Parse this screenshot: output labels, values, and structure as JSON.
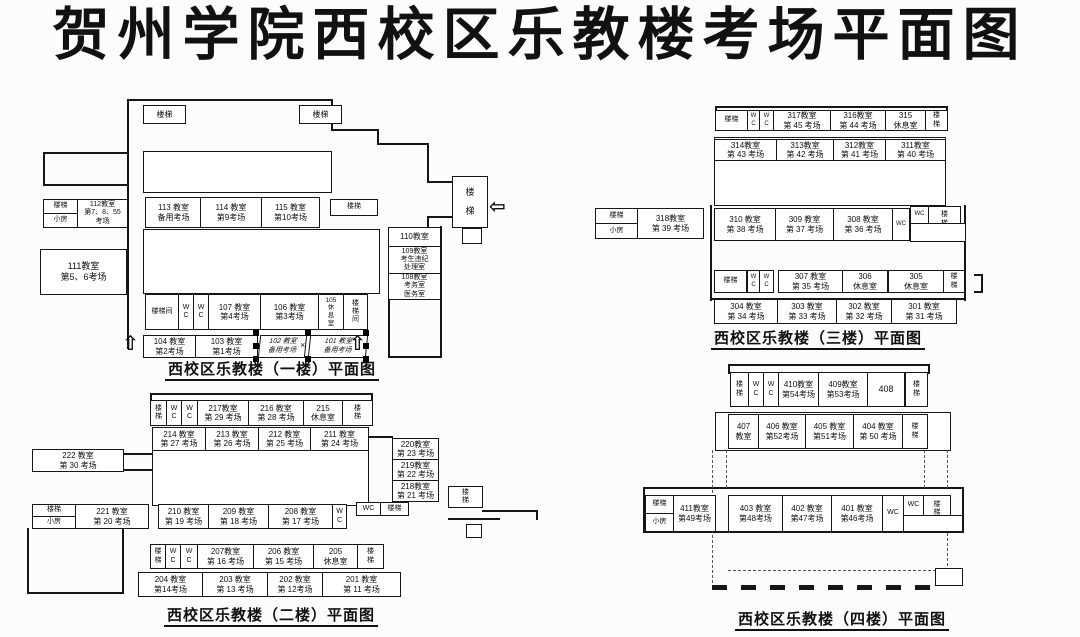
{
  "title": "贺州学院西校区乐教楼考场平面图",
  "labels": {
    "stair": "楼梯",
    "stair_v": "楼\n梯",
    "stairwell": "楼梯间",
    "stairwell_v": "楼\n梯\n间",
    "small_room": "小房",
    "wc_v": "W\nC",
    "wc": "WC",
    "arrow_up": "⇧",
    "arrow_in": "⇦",
    "x_mark": "×"
  },
  "floor1": {
    "caption": "西校区乐教楼（一楼）平面图",
    "r112": "112教室\n第7、8、55\n考场",
    "r111": "111教室\n第5、6考场",
    "r113": "113 教室\n备用考场",
    "r114": "114 教室\n第9考场",
    "r115": "115 教室\n第10考场",
    "r110": "110教室",
    "r109": "109教室\n考生违纪\n处理室",
    "r108": "108教室\n考务室\n医务室",
    "r107": "107 教室\n第4考场",
    "r106": "106 教室\n第3考场",
    "r105": "105\n休\n息\n室",
    "r104": "104 教室\n第2考场",
    "r103": "103 教室\n第1考场",
    "r102": "102 教室\n备用考场",
    "r101": "101 教室\n备用考场"
  },
  "floor2": {
    "caption": "西校区乐教楼（二楼）平面图",
    "r217": "217教室\n第 29 考场",
    "r216": "216 教室\n第 28 考场",
    "r215": "215\n休息室",
    "r214": "214 教室\n第 27 考场",
    "r213": "213 教室\n第 26 考场",
    "r212": "212 教室\n第 25 考场",
    "r211": "211 教室\n第 24 考场",
    "r222": "222 教室\n第 30 考场",
    "r220": "220教室\n第 23 考场",
    "r219": "219教室\n第 22 考场",
    "r218": "218教室\n第 21 考场",
    "r221": "221 教室\n第 20 考场",
    "r210": "210 教室\n第 19 考场",
    "r209": "209 教室\n第 18 考场",
    "r208": "208 教室\n第 17 考场",
    "r207": "207教室\n第 16 考场",
    "r206": "206 教室\n第 15 考场",
    "r205": "205\n休息室",
    "r204": "204 教室\n第14考场",
    "r203": "203 教室\n第 13 考场",
    "r202": "202 教室\n第 12考场",
    "r201": "201 教室\n第 11 考场"
  },
  "floor3": {
    "caption": "西校区乐教楼（三楼）平面图",
    "r317": "317教室\n第 45 考场",
    "r316": "316教室\n第 44 考场",
    "r315": "315\n休息室",
    "r314": "314教室\n第 43 考场",
    "r313": "313教室\n第 42 考场",
    "r312": "312教室\n第 41 考场",
    "r311": "311教室\n第 40 考场",
    "r318": "318教室\n第 39 考场",
    "r310": "310 教室\n第 38 考场",
    "r309": "309 教室\n第 37 考场",
    "r308": "308 教室\n第 36 考场",
    "r307": "307 教室\n第 35 考场",
    "r306": "306\n休息室",
    "r305": "305\n休息室",
    "r304": "304 教室\n第 34 考场",
    "r303": "303 教室\n第 33 考场",
    "r302": "302 教室\n第 32 考场",
    "r301": "301 教室\n第 31 考场"
  },
  "floor4": {
    "caption": "西校区乐教楼（四楼）平面图",
    "r410": "410教室\n第54考场",
    "r409": "409教室\n第53考场",
    "r408": "408",
    "r407": "407\n教室",
    "r406": "406 教室\n第52考场",
    "r405": "405 教室\n第51考场",
    "r404": "404 教室\n第 50 考场",
    "r411": "411教室\n第49考场",
    "r403": "403 教室\n第48考场",
    "r402": "402 教室\n第47考场",
    "r401": "401 教室\n第46考场"
  }
}
